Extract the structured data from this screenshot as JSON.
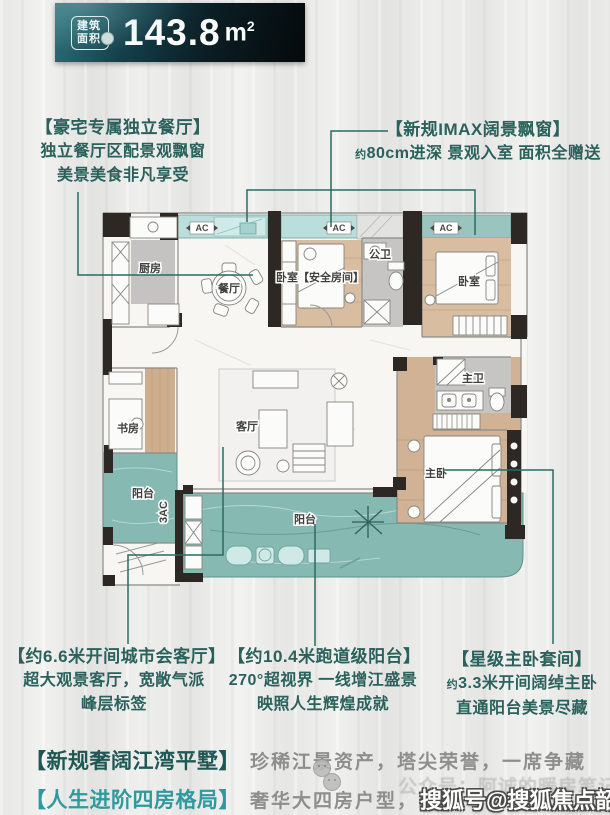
{
  "badge": {
    "chip_top": "建筑",
    "chip_bottom": "面积",
    "value": "143.8",
    "unit_base": "m",
    "unit_sup": "2"
  },
  "callouts": {
    "dining": {
      "title": "【豪宅专属独立餐厅】",
      "line1": "独立餐厅区配景观飘窗",
      "line2": "美景美食非凡享受"
    },
    "bay_window": {
      "title": "【新规IMAX阔景飘窗】",
      "about": "约",
      "line1": "80cm进深 景观入室 面积全赠送"
    },
    "living": {
      "title": "【约6.6米开间城市会客厅】",
      "line1": "超大观景客厅，宽敞气派",
      "line2": "峰层标签"
    },
    "runway_balcony": {
      "title": "【约10.4米跑道级阳台】",
      "line1": "270°超视界 一线增江盛景",
      "line2": "映照人生辉煌成就"
    },
    "master_suite": {
      "title": "【星级主卧套间】",
      "about": "约",
      "line1": "3.3米开间阔绰主卧",
      "line2": "直通阳台美景尽藏"
    }
  },
  "plan": {
    "labels": {
      "kitchen": "厨房",
      "dining": "餐厅",
      "safe_bedroom": "卧室【安全房间】",
      "public_bath": "公卫",
      "bedroom": "卧室",
      "master_bath": "主卫",
      "master_bedroom": "主卧",
      "study": "书房",
      "living": "客厅",
      "balcony_left": "阳台",
      "balcony_main": "阳台",
      "ac": "AC",
      "ac3": "3AC"
    }
  },
  "footer": {
    "tag1": "【新规奢阔江湾平墅】",
    "text1": "珍稀江景资产，塔尖荣誉，一席争藏",
    "tag2": "【人生进阶四房格局】",
    "text2": "奢华大四房户型，两梯",
    "faint_text": "公众号：阿诚的暖房笔记",
    "watermark": "搜狐号@搜狐焦点韶关站"
  },
  "colors": {
    "accent_teal": "#2a615c",
    "bright_teal": "#2e9aa0",
    "balcony": "#86b9b2",
    "bay_window": "#b9dedb",
    "wood": "#d8bda1",
    "wall": "#2e2824",
    "gray_text": "#8e8e8c"
  }
}
